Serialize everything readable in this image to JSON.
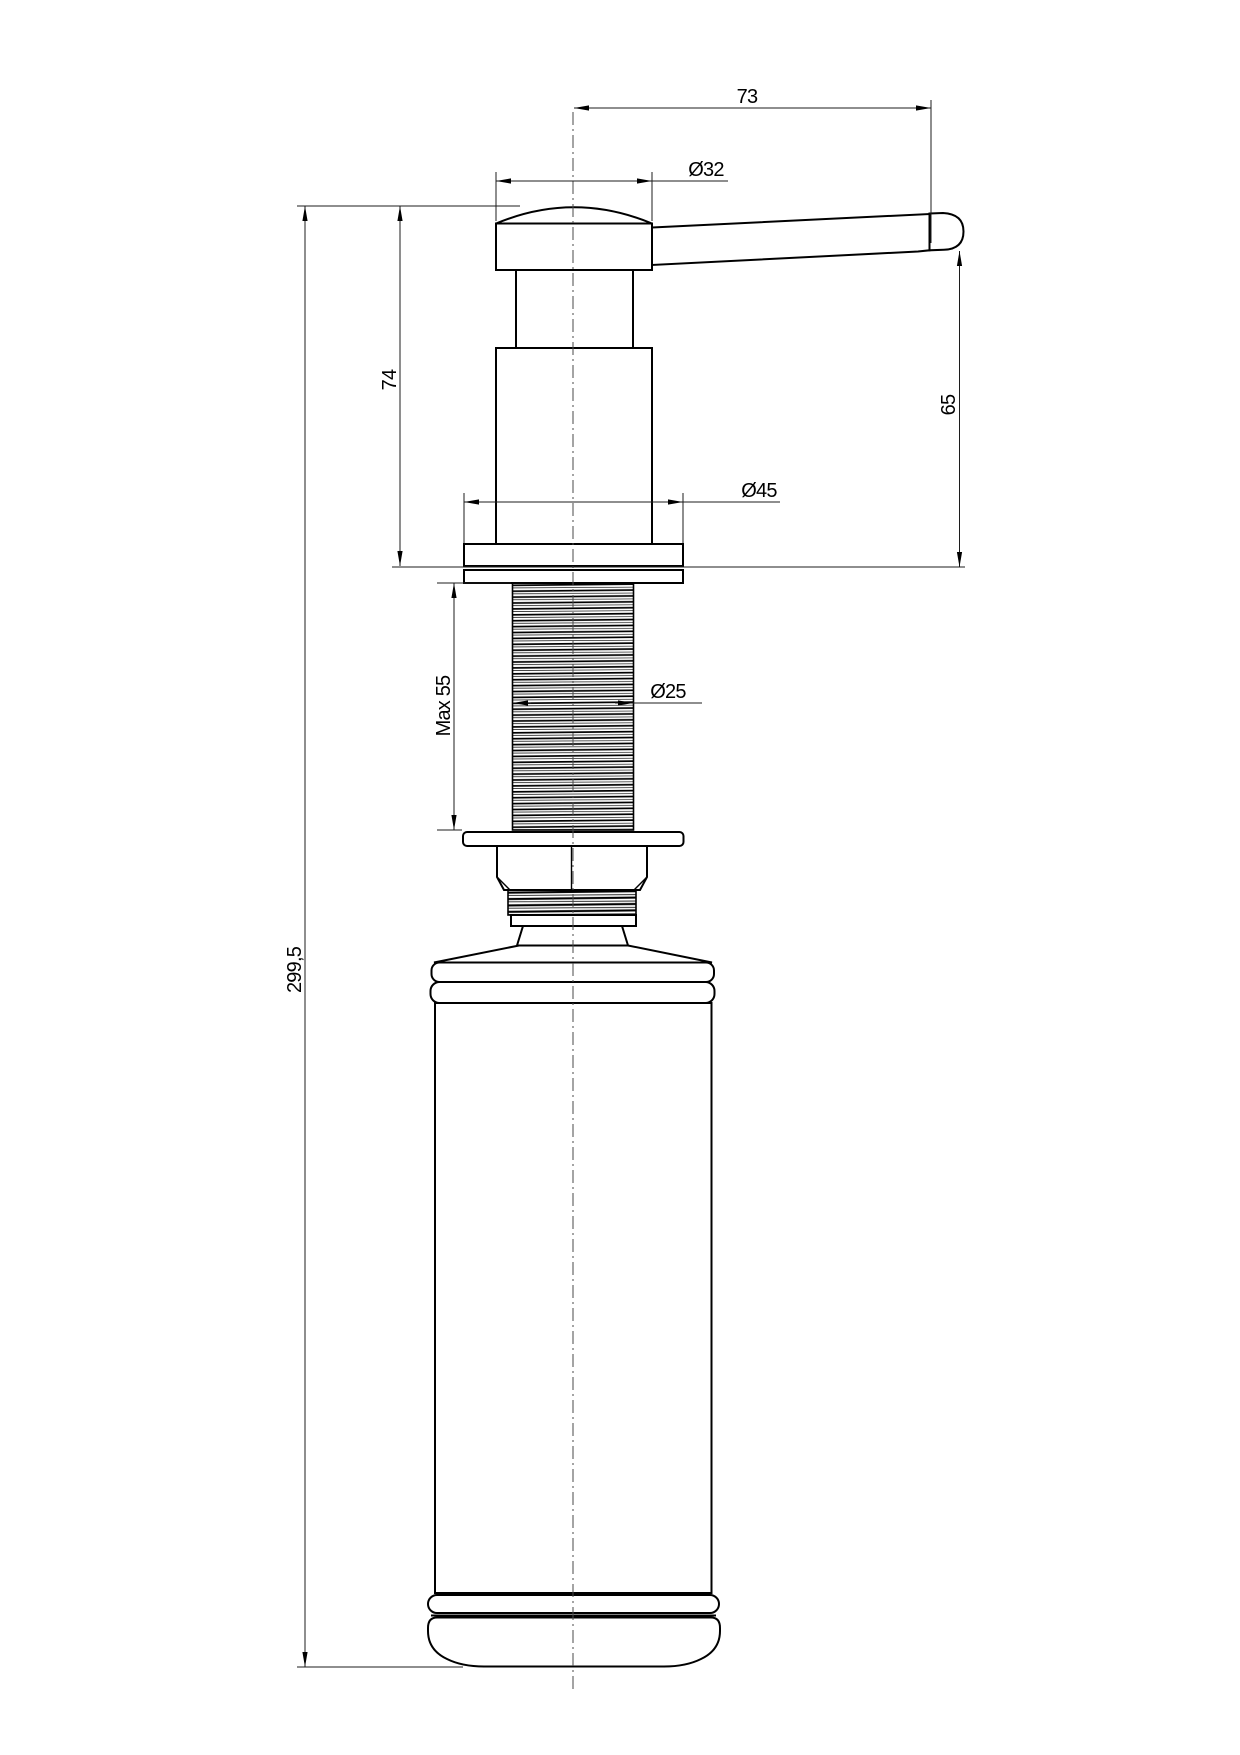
{
  "drawing": {
    "subject": "soap-dispenser-technical-drawing",
    "background_color": "#ffffff",
    "line_color": "#000000",
    "dimensions": {
      "spout_reach": "73",
      "head_diameter": "Ø32",
      "head_height": "74",
      "spout_outlet_height": "65",
      "flange_diameter": "Ø45",
      "mounting_thread_length": "Max 55",
      "thread_diameter": "Ø25",
      "overall_height": "299,5"
    }
  }
}
